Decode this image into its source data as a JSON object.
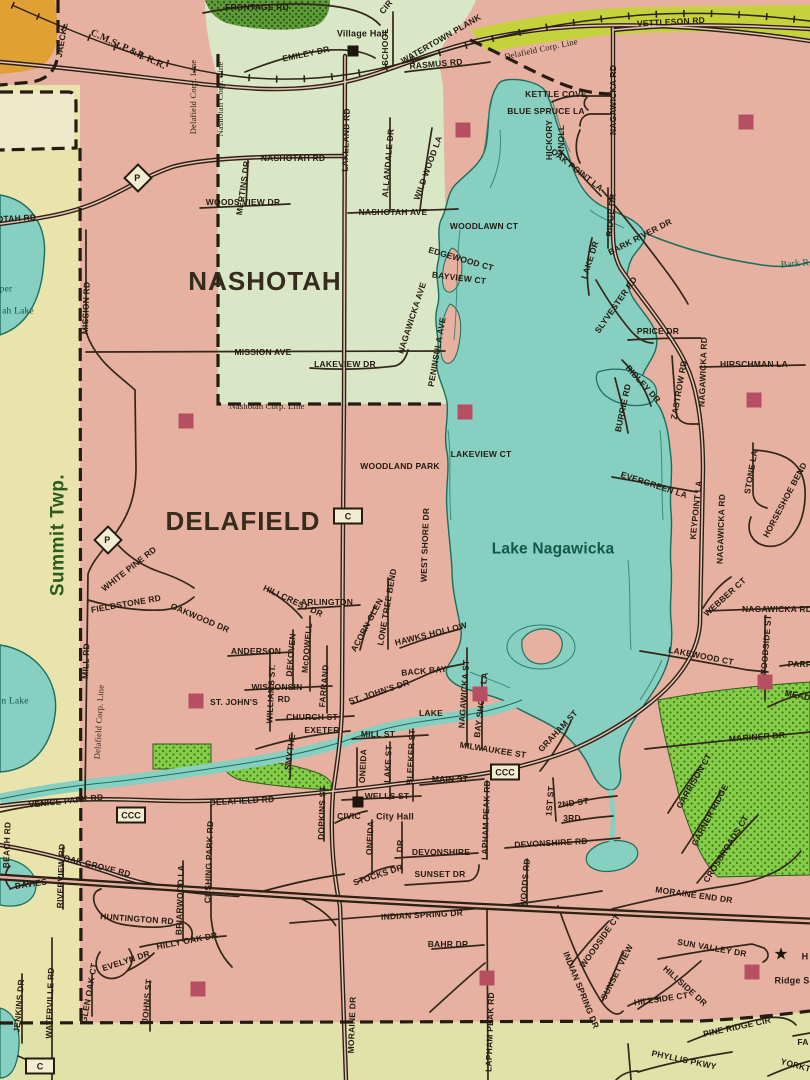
{
  "map_type": "street-map",
  "municipality_labels": [
    "NASHOTAH",
    "DELAFIELD",
    "Summit Twp."
  ],
  "water_labels": [
    "Lake Nagawicka",
    "Bark R"
  ],
  "palette": {
    "delafield_pink": "#e7b1a1",
    "nashotah_green": "#d9e7c6",
    "summit_yellow": "#e9e4ab",
    "bottom_olive": "#dfe3a9",
    "water_teal": "#87cfc0",
    "park_green": "#85cc47",
    "woods_dark_green": "#5f9c38",
    "highway_band": "#c5d23c",
    "building_orange": "#e0a033",
    "landmark_red": "#b74f63",
    "ink": "#241b10"
  },
  "labels": [
    [
      "FRONTAGE RD",
      257,
      7,
      0,
      "rd"
    ],
    [
      "CIR",
      386,
      7,
      -50,
      "rd"
    ],
    [
      "Village Hall",
      362,
      34,
      0,
      "poi"
    ],
    [
      "SCHOOL",
      385,
      47,
      -90,
      "rd"
    ],
    [
      "JAECKL",
      62,
      40,
      -80,
      "rd"
    ],
    [
      "C.M.St.P.&P. R.R.",
      128,
      50,
      25,
      "rr"
    ],
    [
      "EMILEY DR",
      306,
      54,
      -12,
      "rd"
    ],
    [
      "WATERTOWN PLANK",
      441,
      39,
      -30,
      "rd"
    ],
    [
      "RASMUS RD",
      436,
      64,
      -5,
      "rd"
    ],
    [
      "Delafield Corp. Line",
      193,
      97,
      -90,
      "corp"
    ],
    [
      "Nashotah Corp. Line",
      220,
      99,
      -90,
      "corp"
    ],
    [
      "Delafield Corp. Line",
      541,
      49,
      -12,
      "corp"
    ],
    [
      "VETTLESON RD",
      671,
      22,
      -3,
      "rd"
    ],
    [
      "KETTLE COVE",
      556,
      94,
      0,
      "rd"
    ],
    [
      "BLUE SPRUCE LA",
      546,
      111,
      0,
      "rd"
    ],
    [
      "HICKORY",
      549,
      140,
      -90,
      "rd"
    ],
    [
      "KNOLL",
      561,
      140,
      -90,
      "rd"
    ],
    [
      "NAGAWICKA RD",
      613,
      100,
      -90,
      "rd"
    ],
    [
      "OAK POINT LA",
      577,
      170,
      38,
      "rd"
    ],
    [
      "RIDGE DR",
      611,
      215,
      -85,
      "rd"
    ],
    [
      "LAKE DR",
      590,
      260,
      -72,
      "rd"
    ],
    [
      "BARK RIVER DR",
      640,
      237,
      -27,
      "rd"
    ],
    [
      "Bark R",
      795,
      265,
      -5,
      "wat"
    ],
    [
      "SLYVESTER RD",
      616,
      305,
      -55,
      "rd"
    ],
    [
      "PRICE DR",
      658,
      331,
      0,
      "rd"
    ],
    [
      "NAGAWICKA RD",
      703,
      372,
      -88,
      "rd"
    ],
    [
      "HIRSCHMAN LA",
      754,
      364,
      0,
      "rd"
    ],
    [
      "RIDLEY DR",
      643,
      384,
      48,
      "rd"
    ],
    [
      "ZASTROW RD",
      679,
      390,
      -80,
      "rd"
    ],
    [
      "BURRIE RD",
      623,
      408,
      -78,
      "rd"
    ],
    [
      "EVERGREEN LA",
      654,
      485,
      18,
      "rd"
    ],
    [
      "KEYPOINT LA",
      696,
      510,
      -84,
      "rd"
    ],
    [
      "NAGAWICKA RD",
      721,
      529,
      -88,
      "rd"
    ],
    [
      "STONE LA",
      751,
      472,
      -80,
      "rd"
    ],
    [
      "HORSESHOE BEND",
      785,
      500,
      -62,
      "rd"
    ],
    [
      "WEBBER CT",
      725,
      597,
      -42,
      "rd"
    ],
    [
      "NAGAWICKA RD",
      777,
      609,
      0,
      "rd"
    ],
    [
      "WOODSIDE ST",
      766,
      646,
      -85,
      "rd"
    ],
    [
      "LAKEWOOD CT",
      701,
      656,
      11,
      "rd"
    ],
    [
      "PARR",
      800,
      664,
      0,
      "rd"
    ],
    [
      "MEADOW",
      805,
      697,
      12,
      "rd"
    ],
    [
      "MARINER DR",
      757,
      737,
      -4,
      "rd"
    ],
    [
      "GARRISON CT",
      694,
      781,
      -60,
      "rd"
    ],
    [
      "GARNER RIDGE",
      710,
      815,
      -62,
      "rd"
    ],
    [
      "CROSSROADS CT",
      726,
      849,
      -58,
      "rd"
    ],
    [
      "MORAINE END DR",
      694,
      895,
      8,
      "rd"
    ],
    [
      "WOODSIDE CT",
      600,
      941,
      -55,
      "rd"
    ],
    [
      "SUN VALLEY DR",
      712,
      948,
      10,
      "rd"
    ],
    [
      "SUNSET VIEW",
      617,
      972,
      -63,
      "rd"
    ],
    [
      "HILLSIDE DR",
      685,
      986,
      42,
      "rd"
    ],
    [
      "HILLSIDE CT",
      661,
      999,
      -8,
      "rd"
    ],
    [
      "INDIAN SPRING DR",
      581,
      990,
      68,
      "rd"
    ],
    [
      "PINE RIDGE CIR",
      737,
      1027,
      -12,
      "rd"
    ],
    [
      "PHYLLIS PKWY",
      684,
      1060,
      12,
      "rd"
    ],
    [
      "YORKTOWN",
      806,
      1068,
      15,
      "rd"
    ],
    [
      "FA",
      803,
      1042,
      0,
      "rd"
    ],
    [
      "H",
      805,
      957,
      0,
      "poi"
    ],
    [
      "Ridge S",
      792,
      981,
      0,
      "poi"
    ],
    [
      "NASHOTAH RD",
      293,
      158,
      0,
      "rd"
    ],
    [
      "NASHOTAH RD",
      4,
      219,
      -3,
      "rd"
    ],
    [
      "MERTINS DR",
      243,
      188,
      -82,
      "rd"
    ],
    [
      "WOODS VIEW DR",
      243,
      202,
      0,
      "rd"
    ],
    [
      "MISSION RD",
      86,
      308,
      -88,
      "rd"
    ],
    [
      "NASHOTAH",
      265,
      281,
      0,
      "big"
    ],
    [
      "LAKELAND RD",
      346,
      140,
      -88,
      "rd"
    ],
    [
      "ALLANDALE DR",
      388,
      163,
      -85,
      "rd"
    ],
    [
      "WILD WOOD LA",
      428,
      168,
      -70,
      "rd"
    ],
    [
      "NASHOTAH AVE",
      393,
      212,
      0,
      "rd"
    ],
    [
      "WOODLAWN CT",
      484,
      226,
      0,
      "rd"
    ],
    [
      "EDGEWOOD CT",
      461,
      259,
      16,
      "rd"
    ],
    [
      "BAYVIEW CT",
      459,
      278,
      7,
      "rd"
    ],
    [
      "NAGAWICKA AVE",
      412,
      318,
      -72,
      "rd"
    ],
    [
      "PENINSULA AVE",
      437,
      352,
      -80,
      "rd"
    ],
    [
      "MISSION AVE",
      263,
      352,
      0,
      "rd"
    ],
    [
      "LAKEVIEW DR",
      345,
      364,
      0,
      "rd"
    ],
    [
      "Nashotah Corp. Line",
      267,
      406,
      0,
      "corp"
    ],
    [
      "per",
      6,
      290,
      0,
      "wat"
    ],
    [
      "ah Lake",
      18,
      312,
      0,
      "wat"
    ],
    [
      "n Lake",
      15,
      702,
      0,
      "wat"
    ],
    [
      "WOODLAND PARK",
      400,
      466,
      0,
      "rd"
    ],
    [
      "LAKEVIEW CT",
      481,
      454,
      0,
      "rd"
    ],
    [
      "DELAFIELD",
      243,
      521,
      0,
      "big"
    ],
    [
      "WEST SHORE DR",
      425,
      545,
      -88,
      "rd"
    ],
    [
      "Lake Nagawicka",
      553,
      549,
      0,
      "lake"
    ],
    [
      "Summit Twp.",
      58,
      535,
      -90,
      "town"
    ],
    [
      "WHITE PINE RD",
      129,
      569,
      -38,
      "rd"
    ],
    [
      "FIELDSTONE RD",
      126,
      604,
      -10,
      "rd"
    ],
    [
      "OAKWOOD DR",
      200,
      618,
      23,
      "rd"
    ],
    [
      "MILL RD",
      86,
      661,
      -88,
      "rd"
    ],
    [
      "Delafield Corp. Line",
      99,
      722,
      -87,
      "corp"
    ],
    [
      "HILLCREST DR",
      293,
      601,
      25,
      "rd"
    ],
    [
      "ARLINGTON",
      327,
      602,
      0,
      "rd"
    ],
    [
      "LONE TREE BEND",
      387,
      607,
      -80,
      "rd"
    ],
    [
      "ACORN GLEN",
      367,
      625,
      -62,
      "rd"
    ],
    [
      "HAWKS HOLLOW",
      431,
      634,
      -14,
      "rd"
    ],
    [
      "ANDERSON",
      256,
      651,
      0,
      "rd"
    ],
    [
      "DEKOVEN",
      291,
      655,
      -85,
      "rd"
    ],
    [
      "McDOWELL",
      307,
      648,
      -85,
      "rd"
    ],
    [
      "WISCONSIN",
      277,
      687,
      0,
      "rd"
    ],
    [
      "RD",
      284,
      699,
      0,
      "rd"
    ],
    [
      "WILLIAMS ST.",
      271,
      694,
      -87,
      "rd"
    ],
    [
      "ST. JOHN'S",
      234,
      702,
      0,
      "rd"
    ],
    [
      "FARRAND",
      324,
      686,
      -85,
      "rd"
    ],
    [
      "CHURCH ST",
      312,
      717,
      0,
      "rd"
    ],
    [
      "SMYTHE",
      290,
      752,
      -82,
      "rd"
    ],
    [
      "EXETER",
      322,
      730,
      0,
      "rd"
    ],
    [
      "ST. JOHN'S DR",
      379,
      692,
      -18,
      "rd"
    ],
    [
      "BACK BAY",
      424,
      671,
      -5,
      "rd"
    ],
    [
      "NAGAWICKA ST",
      464,
      694,
      -86,
      "rd"
    ],
    [
      "BAY SHORE LA",
      481,
      705,
      -83,
      "rd"
    ],
    [
      "LAKE",
      431,
      713,
      0,
      "rd"
    ],
    [
      "MILL ST",
      378,
      734,
      0,
      "rd"
    ],
    [
      "MILWAUKEE ST",
      493,
      750,
      9,
      "rd"
    ],
    [
      "GRAHAM ST",
      558,
      731,
      -47,
      "rd"
    ],
    [
      "MAIN ST",
      450,
      779,
      0,
      "rd"
    ],
    [
      "1ST ST",
      550,
      801,
      -85,
      "rd"
    ],
    [
      "2ND ST",
      573,
      803,
      -8,
      "rd"
    ],
    [
      "3RD",
      572,
      818,
      0,
      "rd"
    ],
    [
      "WELLS ST",
      387,
      796,
      0,
      "rd"
    ],
    [
      "CIVIC",
      349,
      816,
      0,
      "rd"
    ],
    [
      "City Hall",
      395,
      817,
      0,
      "poi"
    ],
    [
      "ONEIDA",
      363,
      766,
      -87,
      "rd"
    ],
    [
      "LAKE ST",
      388,
      764,
      -87,
      "rd"
    ],
    [
      "BLEEKER ST",
      411,
      757,
      -87,
      "rd"
    ],
    [
      "ONEIDA",
      370,
      838,
      -87,
      "rd"
    ],
    [
      "DR",
      400,
      846,
      -87,
      "rd"
    ],
    [
      "DEVONSHIRE",
      441,
      852,
      0,
      "rd"
    ],
    [
      "DEVONSHIRE RD",
      551,
      843,
      -3,
      "rd"
    ],
    [
      "LAPHAM PEAK RD",
      486,
      820,
      -88,
      "rd"
    ],
    [
      "LAPHAM PEAK RD",
      490,
      1032,
      -88,
      "rd"
    ],
    [
      "WOODS RD",
      525,
      883,
      -85,
      "rd"
    ],
    [
      "STOCKS DR",
      378,
      875,
      -18,
      "rd"
    ],
    [
      "SUNSET DR",
      440,
      874,
      0,
      "rd"
    ],
    [
      "INDIAN SPRING DR",
      422,
      915,
      -3,
      "rd"
    ],
    [
      "BAHR DR",
      448,
      944,
      0,
      "rd"
    ],
    [
      "MORAINE DR",
      352,
      1025,
      -88,
      "rd"
    ],
    [
      "HUNTINGTON RD",
      137,
      919,
      4,
      "rd"
    ],
    [
      "BRIARWOOD LA",
      180,
      900,
      -88,
      "rd"
    ],
    [
      "CUSHING PARK RD",
      209,
      862,
      -88,
      "rd"
    ],
    [
      "HILLY OAK DR",
      187,
      941,
      -11,
      "rd"
    ],
    [
      "EVELYN DR",
      126,
      961,
      -18,
      "rd"
    ],
    [
      "GLEN OAK CT",
      89,
      993,
      -80,
      "rd"
    ],
    [
      "JOHNS ST",
      147,
      1001,
      -85,
      "rd"
    ],
    [
      "WATERVILLE RD",
      50,
      1003,
      -88,
      "rd"
    ],
    [
      "JENKINS DR",
      19,
      1006,
      -85,
      "rd"
    ],
    [
      "DAVIES",
      31,
      884,
      -8,
      "rd"
    ],
    [
      "RIVERVIEW RD",
      61,
      876,
      -88,
      "rd"
    ],
    [
      "OAK GROVE RD",
      97,
      866,
      14,
      "rd"
    ],
    [
      "VENICE PARK RD",
      66,
      801,
      -6,
      "rd"
    ],
    [
      "BEACH RD",
      7,
      845,
      -88,
      "rd"
    ],
    [
      "DELAFIELD RD",
      242,
      801,
      -3,
      "rd"
    ],
    [
      "DOPKINS ST",
      322,
      813,
      -88,
      "rd"
    ]
  ],
  "shields": [
    {
      "label": "P",
      "shape": "diamond",
      "x": 138,
      "y": 178
    },
    {
      "label": "P",
      "shape": "diamond",
      "x": 108,
      "y": 540
    },
    {
      "label": "C",
      "shape": "rect",
      "x": 348,
      "y": 516
    },
    {
      "label": "CCC",
      "shape": "rect",
      "x": 131,
      "y": 815
    },
    {
      "label": "CCC",
      "shape": "rect",
      "x": 505,
      "y": 772
    },
    {
      "label": "C",
      "shape": "rect",
      "x": 40,
      "y": 1066
    }
  ],
  "landmarks": {
    "red_squares": [
      [
        186,
        421
      ],
      [
        465,
        412
      ],
      [
        463,
        130
      ],
      [
        746,
        122
      ],
      [
        754,
        400
      ],
      [
        765,
        682
      ],
      [
        196,
        701
      ],
      [
        480,
        694
      ],
      [
        487,
        978
      ],
      [
        198,
        989
      ],
      [
        752,
        972
      ]
    ],
    "black_squares": [
      [
        353,
        51
      ],
      [
        358,
        802
      ]
    ],
    "star": [
      781,
      954
    ]
  }
}
